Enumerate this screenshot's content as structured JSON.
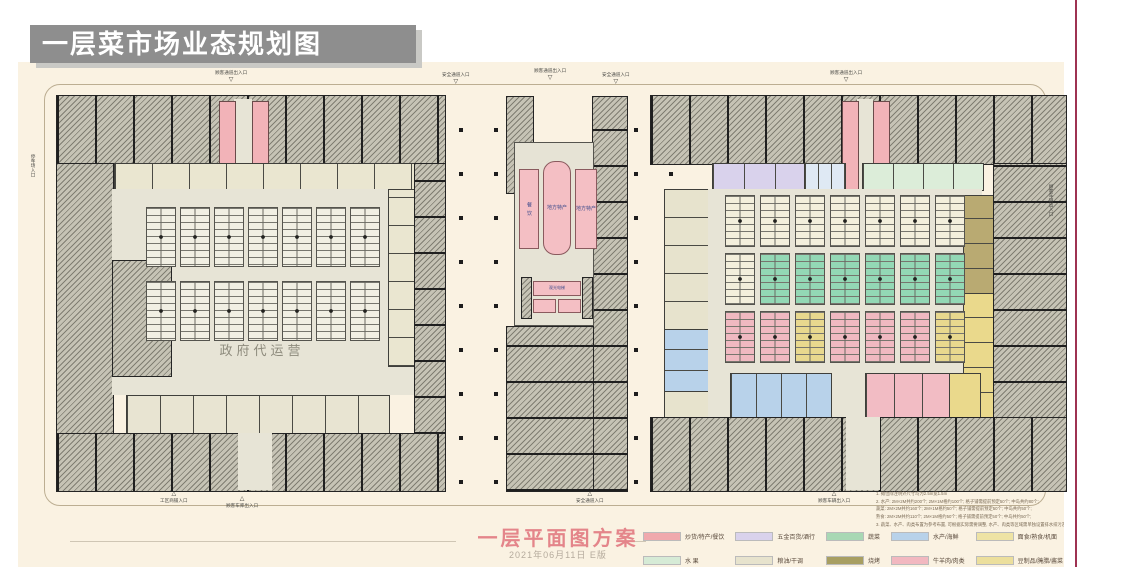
{
  "page": {
    "banner_title": "一层菜市场业态规划图",
    "accent_line_color": "#9e3252",
    "paper_color": "#faf2e2"
  },
  "plan": {
    "left_building": {
      "center_label": "政府代运营"
    },
    "center_block": {
      "dining_label": "餐 饮",
      "special_left_label": "地方特产",
      "special_right_label": "地方特产",
      "elevator_label": "观光电梯"
    },
    "entrances": {
      "left_top": "顾客通道出入口",
      "safety_left": "安全通道入口",
      "center_top": "顾客通道出入口",
      "safety_right": "安全通道入口",
      "right_top": "顾客通道出入口",
      "bottom_left_a": "工区商铺入口",
      "bottom_left_b": "顾客车库出入口",
      "bottom_center": "安全通道入口",
      "bottom_right": "顾客车辆出入口",
      "right_side": "顾客车辆出入口",
      "left_side": "停车场入口"
    }
  },
  "footer": {
    "plan_title": "一层平面图方案",
    "date_version": "2021年06月11日 E版"
  },
  "legend": {
    "columns": [
      {
        "items": [
          {
            "label": "炒货/特产/餐饮",
            "color": "#f0a9ad"
          },
          {
            "label": "水 果",
            "color": "#d6ebd6"
          }
        ]
      },
      {
        "items": [
          {
            "label": "五金百货/酒行",
            "color": "#d9d2ec"
          },
          {
            "label": "粮油/干调",
            "color": "#e7e3cd"
          }
        ]
      },
      {
        "items": [
          {
            "label": "蔬菜",
            "color": "#a8d8b4"
          },
          {
            "label": "烧烤",
            "color": "#a89f62"
          }
        ]
      },
      {
        "items": [
          {
            "label": "水产/海鲜",
            "color": "#b8d2ea"
          },
          {
            "label": "牛羊肉/肉类",
            "color": "#f2b8c0"
          }
        ]
      },
      {
        "items": [
          {
            "label": "面食/熟食/机面",
            "color": "#eee3a4"
          },
          {
            "label": "豆制品/腌腊/酱菜",
            "color": "#ecdf9c"
          }
        ]
      }
    ]
  },
  "notes": {
    "lines": [
      "1. 摊位除注明外尺寸均为2.5m宽1.5m",
      "2. 水产: 2M×2M共约200个; 2M×1M格约100个; 格子铺需提前预定50个; 中岛共约80个;",
      "蔬菜: 2M×2M共约160个; 2M×1M格约50个; 格子铺需提前预定50个; 中岛共约50个;",
      "熟食: 2M×2M共约110个; 2M×1M格约50个; 格子铺需提前预定50个; 中岛共约50个;",
      "3. 蔬菜、水产、肉类布置为参考布置, 可根据实际需要调整, 水产、肉类等区域需单独设置排水排污及警示等配套设施。"
    ]
  }
}
